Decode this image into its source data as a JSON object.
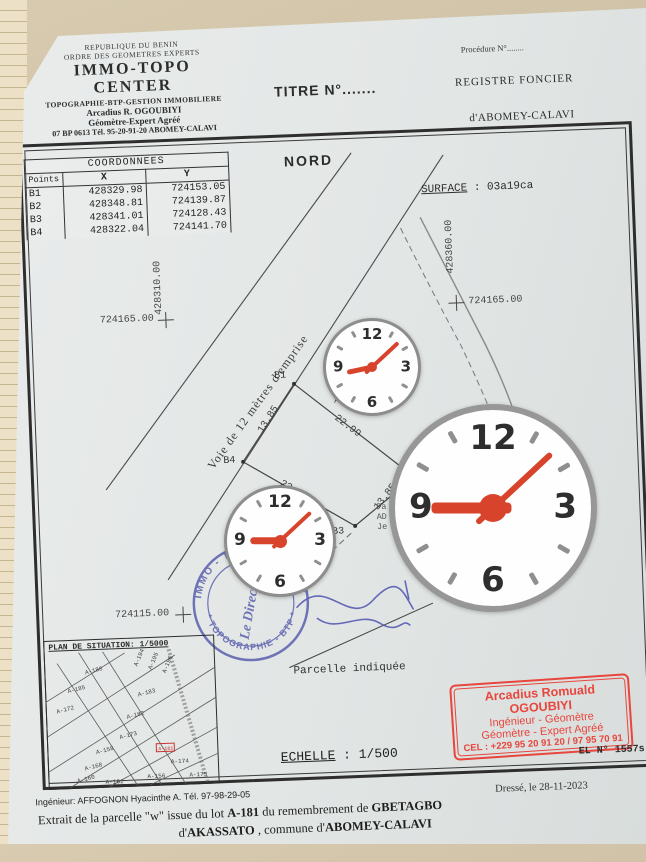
{
  "photo": {
    "paper_color": "#e2e6e5",
    "backdrop_color": "#c9bb9f"
  },
  "header": {
    "org_line1": "REPUBLIQUE DU BENIN",
    "org_line2": "ORDRE DES GEOMETRES EXPERTS",
    "org_name": "IMMO-TOPO CENTER",
    "org_line4": "TOPOGRAPHIE-BTP-GESTION IMMOBILIERE",
    "org_line5": "Arcadius R. OGOUBIYI",
    "org_line6": "Géomètre-Expert Agréé",
    "org_line7": "07 BP 0613 Tél. 95-20-91-20 ABOMEY-CALAVI",
    "titre": "TITRE N°.......",
    "procedure": "Procédure N°........",
    "registre": "REGISTRE FONCIER",
    "registre_ville": "d'ABOMEY-CALAVI"
  },
  "plan": {
    "nord": "NORD",
    "surface_label": "SURFACE",
    "surface_value": ": 03a19ca",
    "coord_table": {
      "title": "COORDONNEES",
      "headers": [
        "Points",
        "X",
        "Y"
      ],
      "rows": [
        [
          "B1",
          "428329.98",
          "724153.05"
        ],
        [
          "B2",
          "428348.81",
          "724139.87"
        ],
        [
          "B3",
          "428341.01",
          "724128.43"
        ],
        [
          "B4",
          "428322.04",
          "724141.70"
        ]
      ]
    },
    "grid_labels": {
      "x_left": "428310.00",
      "y_left": "724165.00",
      "x_right": "428360.00",
      "y_right": "724165.00",
      "y_bottom": "724115.00"
    },
    "road_label": "Voie de 12 mètres d'emprise",
    "points": {
      "b1": "B1",
      "b2": "B2",
      "b3": "B3",
      "b4": "B4"
    },
    "dims": {
      "b4_b1": "13.85",
      "b1_b2": "22.99",
      "b2_b3": "13.85",
      "b3_b4": "23.15"
    },
    "fragments": {
      "f1": "P",
      "f2": "H",
      "f3": "App",
      "f4": "Pa",
      "f5": "AD",
      "f6": "Je"
    },
    "parcelle_note": "Parcelle indiquée",
    "echelle_label": "ECHELLE",
    "echelle_value": ": 1/500",
    "el_number": "EL N° 1557s",
    "dresse": "Dressé, le 28-11-2023",
    "situation": {
      "title": "PLAN DE SITUATION: 1/5000",
      "lots": [
        "A-188",
        "A-185",
        "A-172",
        "A-183",
        "A-182",
        "A-173",
        "A-158",
        "A-168",
        "A-160",
        "A-161",
        "A-174",
        "A-175",
        "A-156",
        "A-194",
        "A-195",
        "A-196"
      ],
      "red_lot": "A-181"
    },
    "stamp_blue": {
      "arc_top": "IMMO - TOPO - CENTER",
      "arc_bottom": "* TOPOGRAPHIE - BTP *",
      "center": "Le Directeur",
      "color": "#5a5fae"
    },
    "stamp_red": {
      "name": "Arcadius Romuald OGOUBIYI",
      "line2": "Ingénieur - Géomètre",
      "line3": "Géomètre - Expert Agréé",
      "line4": "CEL : +229 95 20 91 20 / 97 95 70 91",
      "color": "#e8453c"
    }
  },
  "footer": {
    "engineer": "Ingénieur: AFFOGNON Hyacinthe A. Tél. 97-98-29-05",
    "extrait_pre": "Extrait de la parcelle \"w\" issue du lot ",
    "extrait_lot": "A-181",
    "extrait_mid": " du remembrement de ",
    "extrait_place": "GBETAGBO",
    "line3_pre": "d'",
    "line3_place1": "AKASSATO",
    "line3_mid": " , commune d'",
    "line3_place2": "ABOMEY-CALAVI"
  },
  "clocks": {
    "numerals": [
      "12",
      "3",
      "6",
      "9"
    ],
    "hand_color": "#d8432c",
    "rim_color": "#8d8d8d"
  }
}
